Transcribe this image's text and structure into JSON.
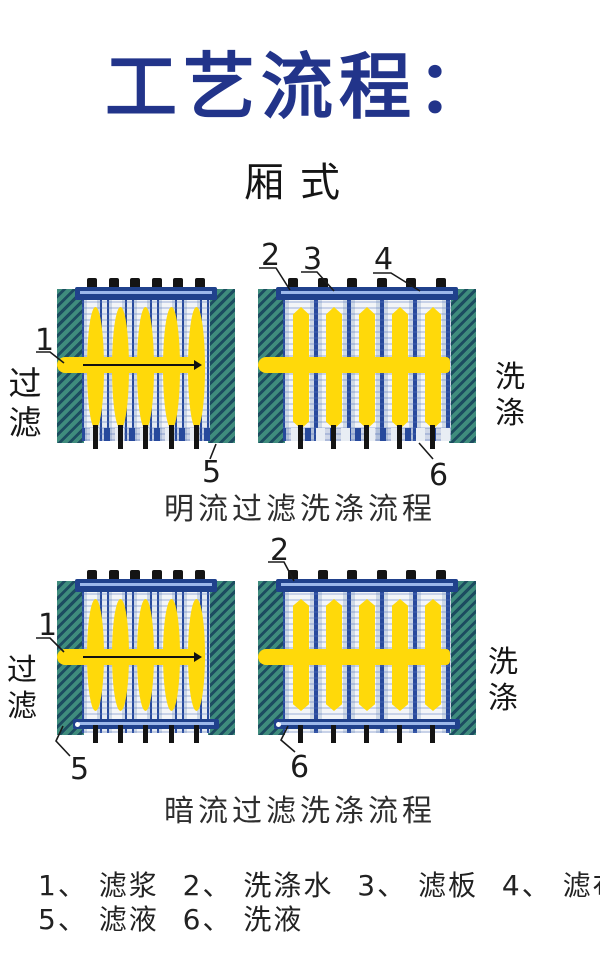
{
  "title": "工艺流程：",
  "subtitle": "厢式",
  "sections": [
    {
      "caption": "明流过滤洗涤流程"
    },
    {
      "caption": "暗流过滤洗涤流程"
    }
  ],
  "side_labels": {
    "filter": "过滤",
    "wash": "洗涤"
  },
  "callouts": {
    "n1": "1",
    "n2": "2",
    "n3": "3",
    "n4": "4",
    "n5": "5",
    "n6": "6"
  },
  "legend": {
    "items": [
      "1、 滤浆",
      "2、 洗涤水",
      "3、 滤板",
      "4、 滤布",
      "5、 滤液",
      "6、 洗液"
    ]
  },
  "colors": {
    "title_navy": "#22348a",
    "endplate_teal": "#3f8c7d",
    "hatch_dark": "#1c4c60",
    "plate_navy": "#27499c",
    "channel_bar_navy": "#20418c",
    "chamber_yellow": "#ffd90a",
    "plate_light": "#eef1f5",
    "outlet_black": "#141414"
  }
}
